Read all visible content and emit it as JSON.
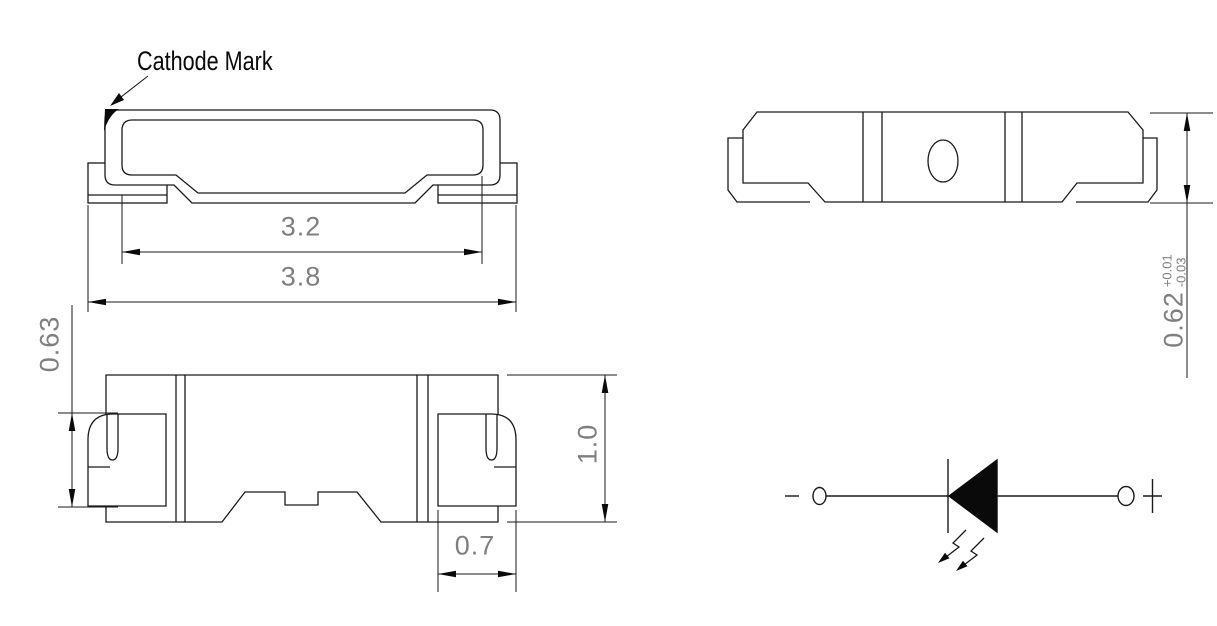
{
  "drawing": {
    "annotation": {
      "cathode_label": "Cathode Mark"
    },
    "views": {
      "top_view": {
        "dim_inner_width": "3.2",
        "dim_outer_width": "3.8"
      },
      "front_view": {
        "dim_pad_height": "0.63",
        "dim_body_height": "1.0",
        "dim_pad_width": "0.7"
      },
      "side_view": {
        "dim_height": "0.62",
        "dim_height_tol_upper": "+0.01",
        "dim_height_tol_lower": "-0.03"
      }
    },
    "schematic": {
      "negative_label": "-",
      "positive_label": "+"
    },
    "colors": {
      "line": "#1a1a1a",
      "dim_text": "#7f7f7f",
      "background": "#ffffff"
    }
  }
}
